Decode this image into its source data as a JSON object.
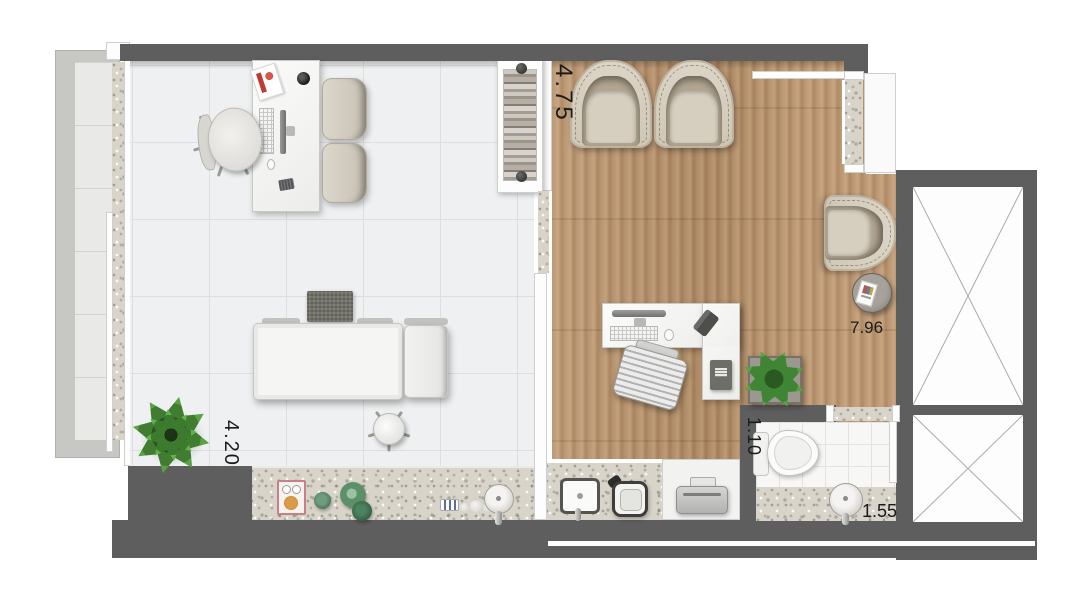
{
  "floor_plan": {
    "dimensions": {
      "left_room_width": "4.20",
      "right_room_width": "4.75",
      "overall_depth": "7.96",
      "bathroom_width": "1.10",
      "bathroom_counter_length": "1.55"
    },
    "colors": {
      "wall": "#5e5e5e",
      "wood_floor": "#b58c63",
      "tile_floor": "#eff0f1",
      "granite": "#d9d4ca",
      "balcony_railing": "#c7c7c3",
      "plant_green": "#3e8a35"
    },
    "icons": {
      "shaft_cross": "diagonal-cross-lines"
    }
  }
}
